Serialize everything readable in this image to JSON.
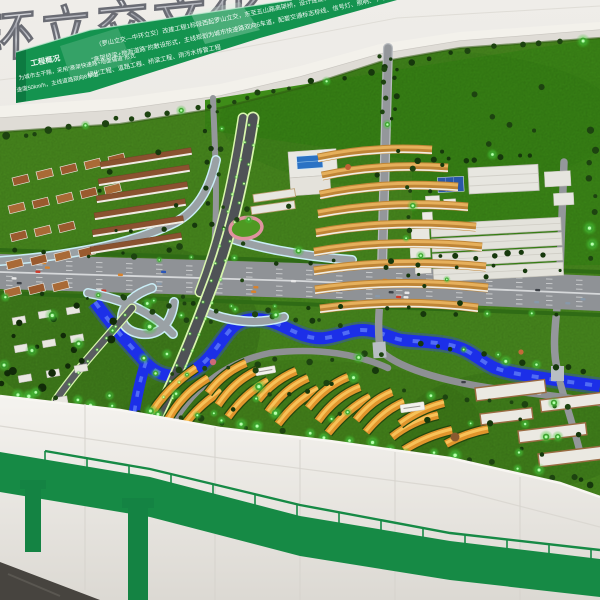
{
  "scene": {
    "subject": "Architectural scale model of an urban expressway interchange project displayed in an exhibition hall",
    "sign_3d": {
      "text": "环立交文化",
      "style": "chrome-3d-letters"
    },
    "banner": {
      "label": "工程概况",
      "left_lines": [
        "为城市主干路，采用“高架快速路+地面辅道”形式",
        "速度50km/h，主线道路双向8车道"
      ],
      "lines": [
        "（罗山立交—中环立交）改建工程1标段西起罗山立交，东至五山路高架桥，设计速度60km/h，全线",
        "“高架桥梁+地面道路”的敷设形式，主线规划为城市快速路双向6车道，配套交通标志标线、信号灯、照明、 声屏障等相关交通设施",
        "绿化工程、道路工程、桥梁工程、雨污水排管工程"
      ],
      "bg": "#14934f",
      "text_color": "#ffffff"
    },
    "model": {
      "ground": "#4a8d1f",
      "upper_lawn": "#3e8c18",
      "river_color": "#1c2fe8",
      "road_color": "#90939a",
      "led_tree_color": "#55e84e",
      "roof_gold": "#e29a30",
      "roof_brown": "#9a5a2e",
      "warehouse_color": "#e2e1da",
      "glass_blue": "#2b72c4",
      "track_pink": "#e093a0"
    },
    "display_wall": {
      "wall": "#e9e6e1",
      "viaduct_graphic_green": "#168a45",
      "floor": "#474440"
    }
  }
}
